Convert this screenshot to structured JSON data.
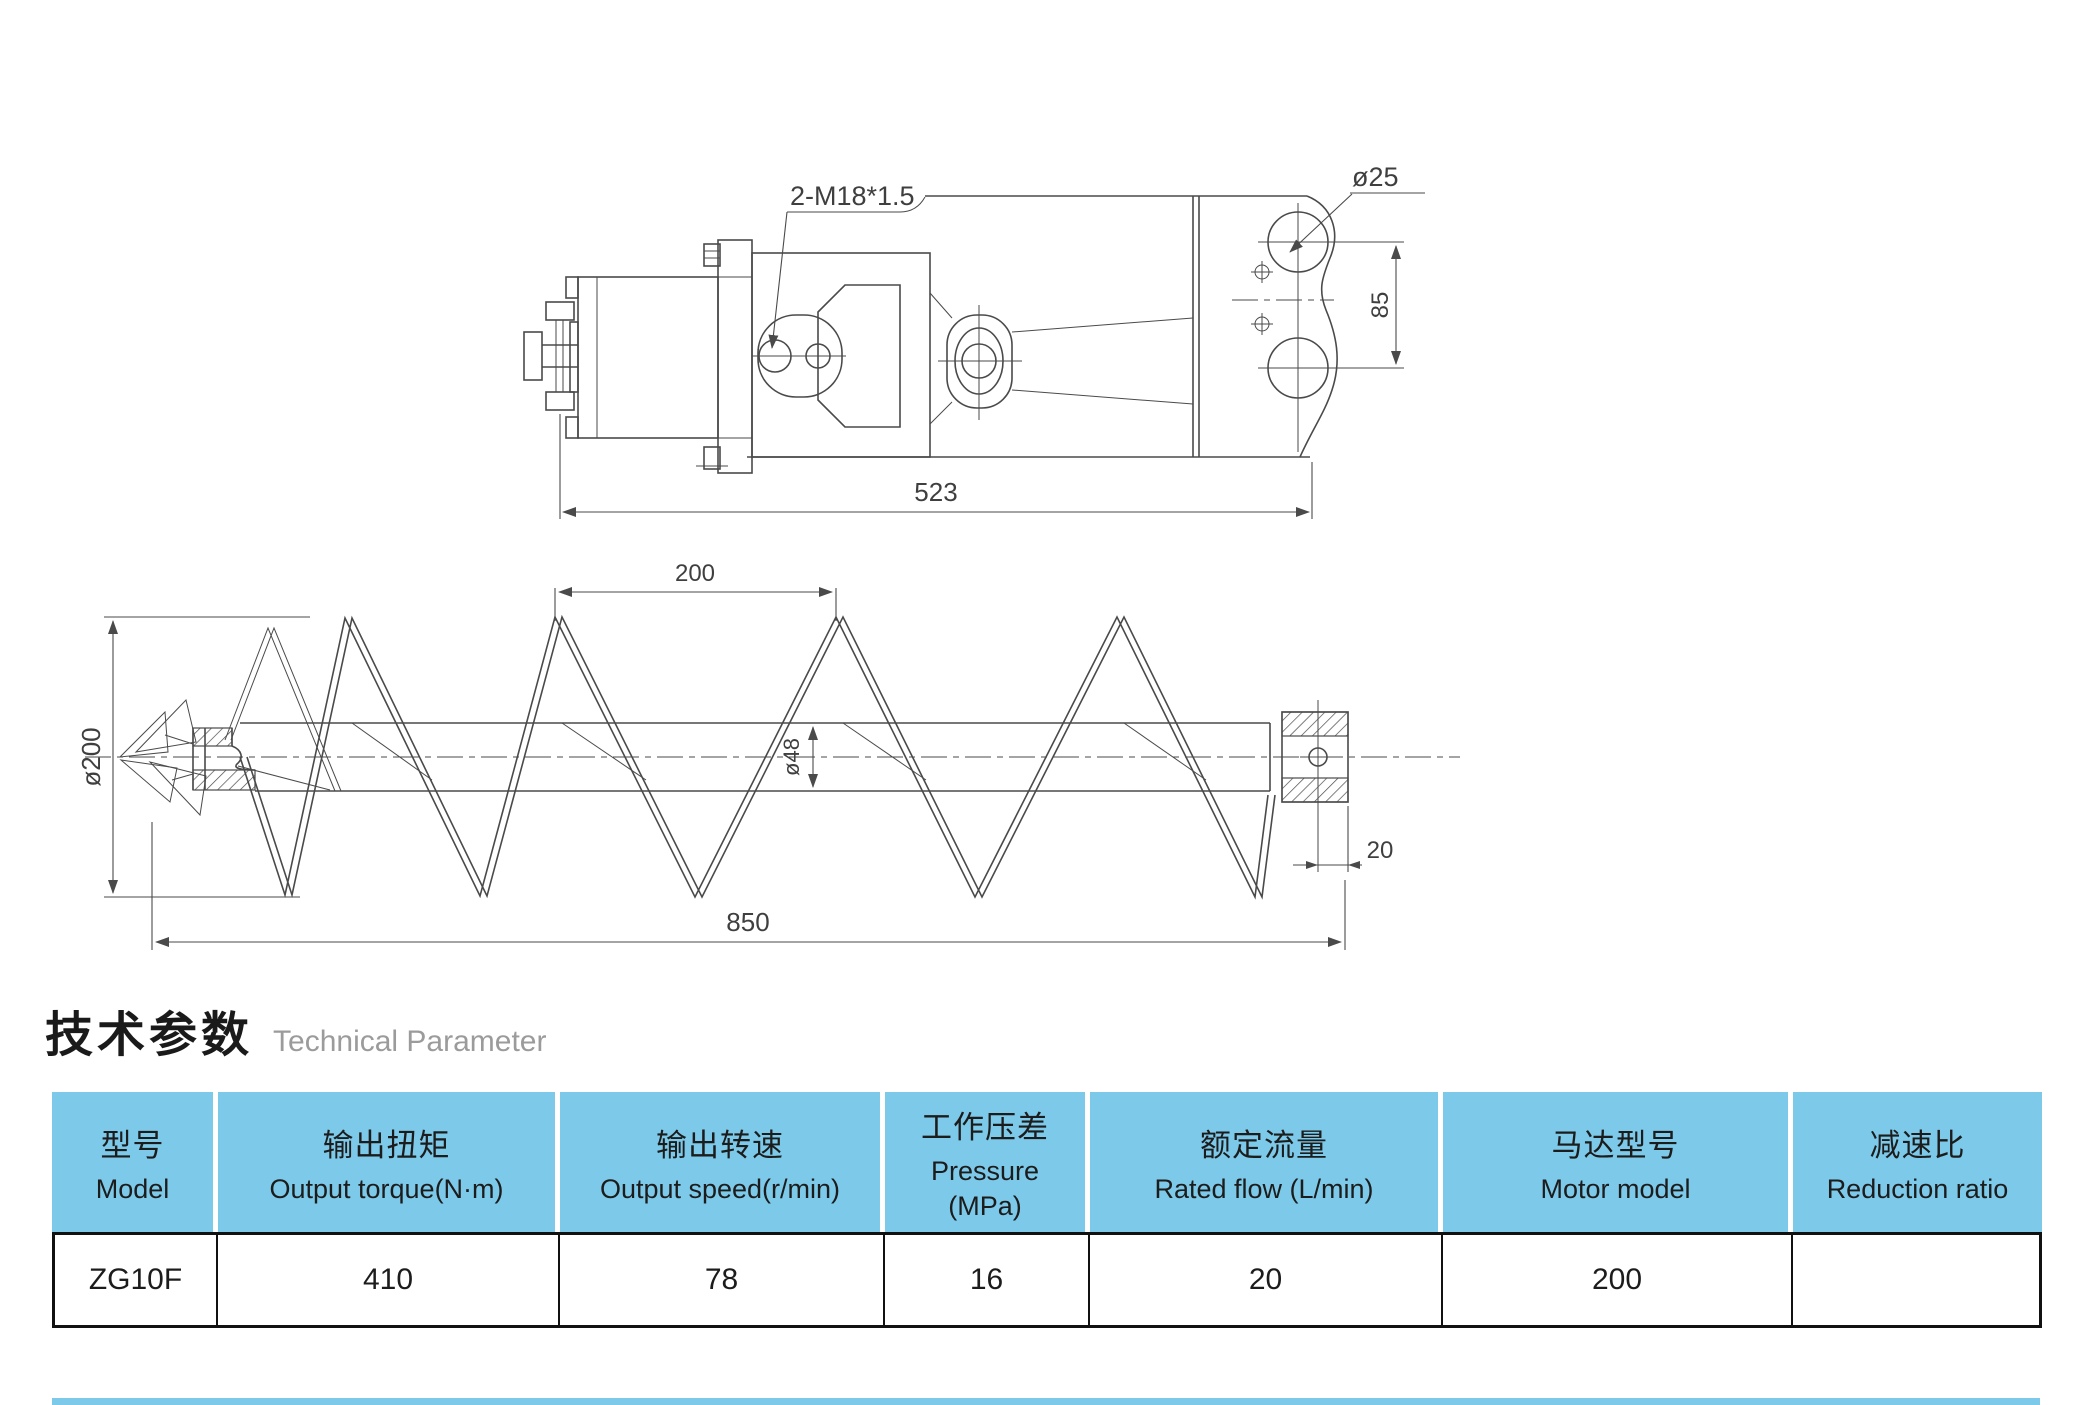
{
  "colors": {
    "header_blue": "#7dc9e9",
    "line": "#4a4a4a"
  },
  "motor_drawing": {
    "dims": {
      "thread": "2-M18*1.5",
      "hole_diameter": "ø25",
      "hole_spacing": "85",
      "length": "523"
    }
  },
  "auger_drawing": {
    "dims": {
      "pitch": "200",
      "outer_diameter": "ø200",
      "tube_diameter": "ø48",
      "length": "850",
      "end_offset": "20"
    }
  },
  "section": {
    "title_zh": "技术参数",
    "title_en": "Technical Parameter"
  },
  "table": {
    "columns": [
      {
        "zh": "型号",
        "en": "Model"
      },
      {
        "zh": "输出扭矩",
        "en": "Output torque(N·m)"
      },
      {
        "zh": "输出转速",
        "en": "Output speed(r/min)"
      },
      {
        "zh": "工作压差",
        "en": "Pressure",
        "en2": "(MPa)"
      },
      {
        "zh": "额定流量",
        "en": "Rated flow (L/min)"
      },
      {
        "zh": "马达型号",
        "en": "Motor model"
      },
      {
        "zh": "减速比",
        "en": "Reduction ratio"
      }
    ],
    "rows": [
      [
        "ZG10F",
        "410",
        "78",
        "16",
        "20",
        "200",
        ""
      ]
    ]
  }
}
